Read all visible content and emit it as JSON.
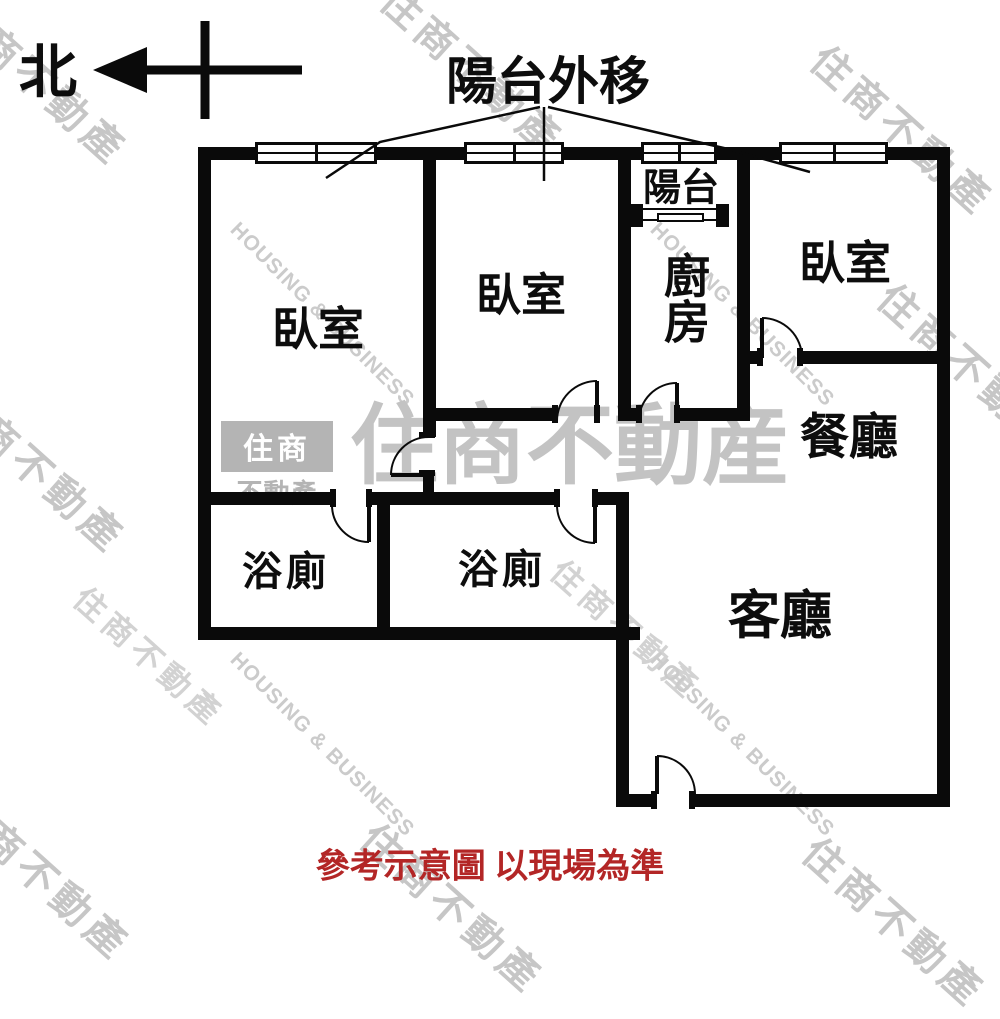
{
  "annotations": {
    "compass": "北",
    "balcony_note": "陽台外移",
    "disclaimer": "參考示意圖 以現場為準"
  },
  "rooms": {
    "bedroom_left": {
      "label": "臥室"
    },
    "bedroom_middle": {
      "label": "臥室"
    },
    "bedroom_right": {
      "label": "臥室"
    },
    "balcony": {
      "label": "陽台"
    },
    "kitchen": {
      "label": "廚房"
    },
    "dining": {
      "label": "餐廳"
    },
    "living": {
      "label": "客廳"
    },
    "bath_left": {
      "label": "浴廁"
    },
    "bath_right": {
      "label": "浴廁"
    }
  },
  "watermarks": {
    "big_text": "住商不動産",
    "stamp_text": "住商不動產",
    "diagonal_text": "HOUSING & BUSINESS",
    "logo_top": "住商",
    "logo_bottom": "不動產"
  },
  "colors": {
    "wall": "#0a0a0a",
    "disclaimer_red": "#b32626",
    "watermark_gray": "#c6c6c6"
  }
}
